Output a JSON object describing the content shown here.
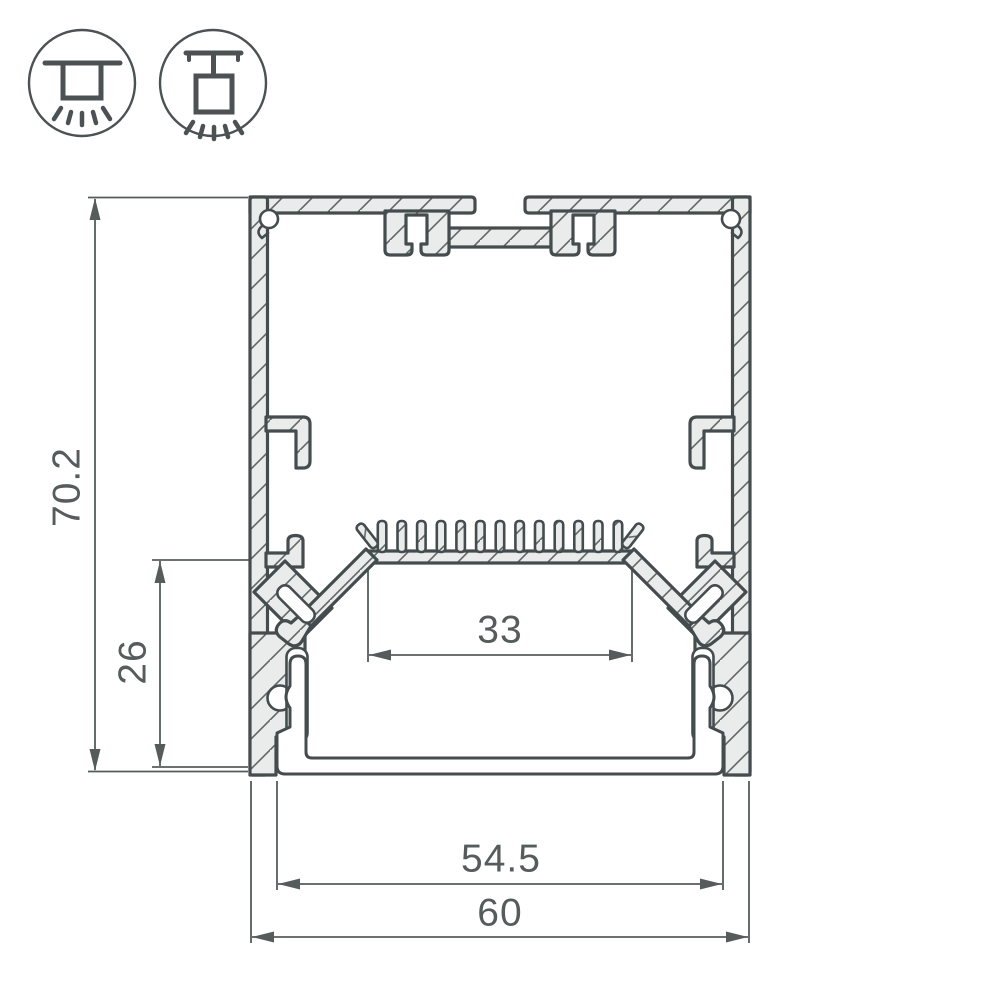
{
  "drawing": {
    "title": "LED profile cross-section technical drawing",
    "dimensions": {
      "total_height": "70.2",
      "lower_inner_height": "26",
      "led_shelf_width": "33",
      "diffuser_width": "54.5",
      "total_width": "60"
    },
    "icons": [
      {
        "name": "surface-mount-icon"
      },
      {
        "name": "pendant-mount-icon"
      }
    ],
    "colors": {
      "outline": "#454c4e",
      "profile_fill": "#eaecec",
      "hatch_line": "#606766",
      "dimension": "#565b5c",
      "background": "#ffffff"
    }
  }
}
